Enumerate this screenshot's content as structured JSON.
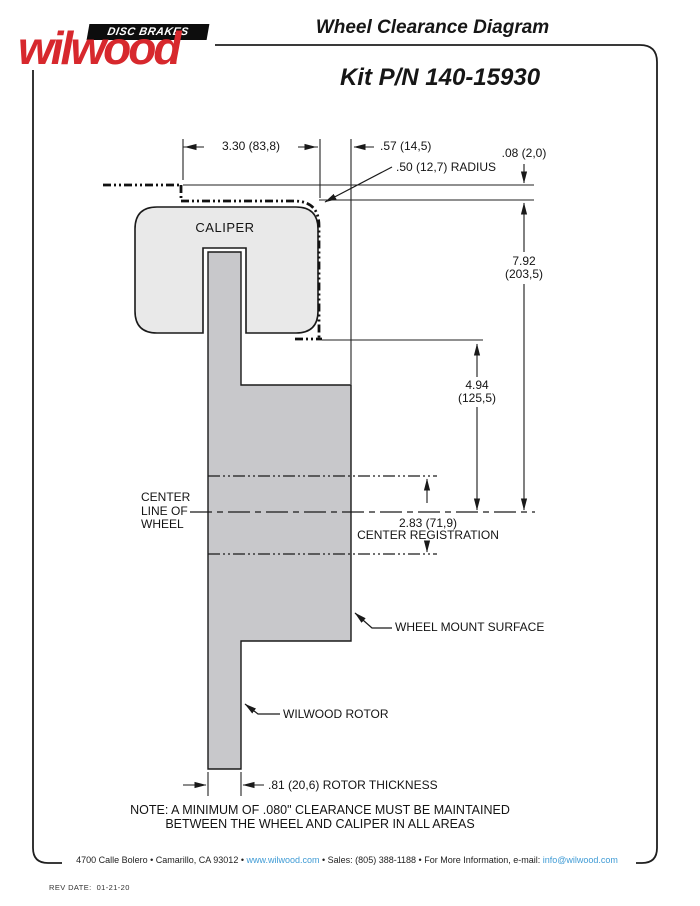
{
  "header": {
    "logo_tagline": "DISC BRAKES",
    "logo_brand": "wilwood",
    "title": "Wheel Clearance Diagram",
    "kit_number": "Kit P/N 140-15930"
  },
  "diagram": {
    "caliper_label": "CALIPER",
    "centerline_label": "CENTER\nLINE OF\nWHEEL",
    "wheel_mount_label": "WHEEL MOUNT SURFACE",
    "rotor_label": "WILWOOD ROTOR",
    "dims": {
      "caliper_width": "3.30 (83,8)",
      "caliper_face_to_mount": ".57 (14,5)",
      "wheel_to_caliper_gap": ".08 (2,0)",
      "corner_radius": ".50 (12,7) RADIUS",
      "mount_top_height": "7.92\n(203,5)",
      "envelope_height": "4.94\n(125,5)",
      "center_registration": "2.83 (71,9)\nCENTER REGISTRATION",
      "rotor_thickness": ".81 (20,6) ROTOR THICKNESS"
    },
    "note": "NOTE: A MINIMUM OF .080\" CLEARANCE MUST BE MAINTAINED\nBETWEEN THE WHEEL AND CALIPER IN ALL AREAS"
  },
  "footer": {
    "address_1": "4700 Calle Bolero • Camarillo, CA 93012 • ",
    "website": "www.wilwood.com",
    "address_2": " • Sales: (805) 388-1188 • For More Information, e-mail: ",
    "email": "info@wilwood.com",
    "rev_date": "REV DATE:  01-21-20"
  },
  "colors": {
    "brand_red": "#d7282d",
    "link_blue": "#3f9bd5",
    "caliper_gray": "#e9e9e9",
    "rotor_gray": "#c8c8cb",
    "line_black": "#1a1a1a"
  }
}
